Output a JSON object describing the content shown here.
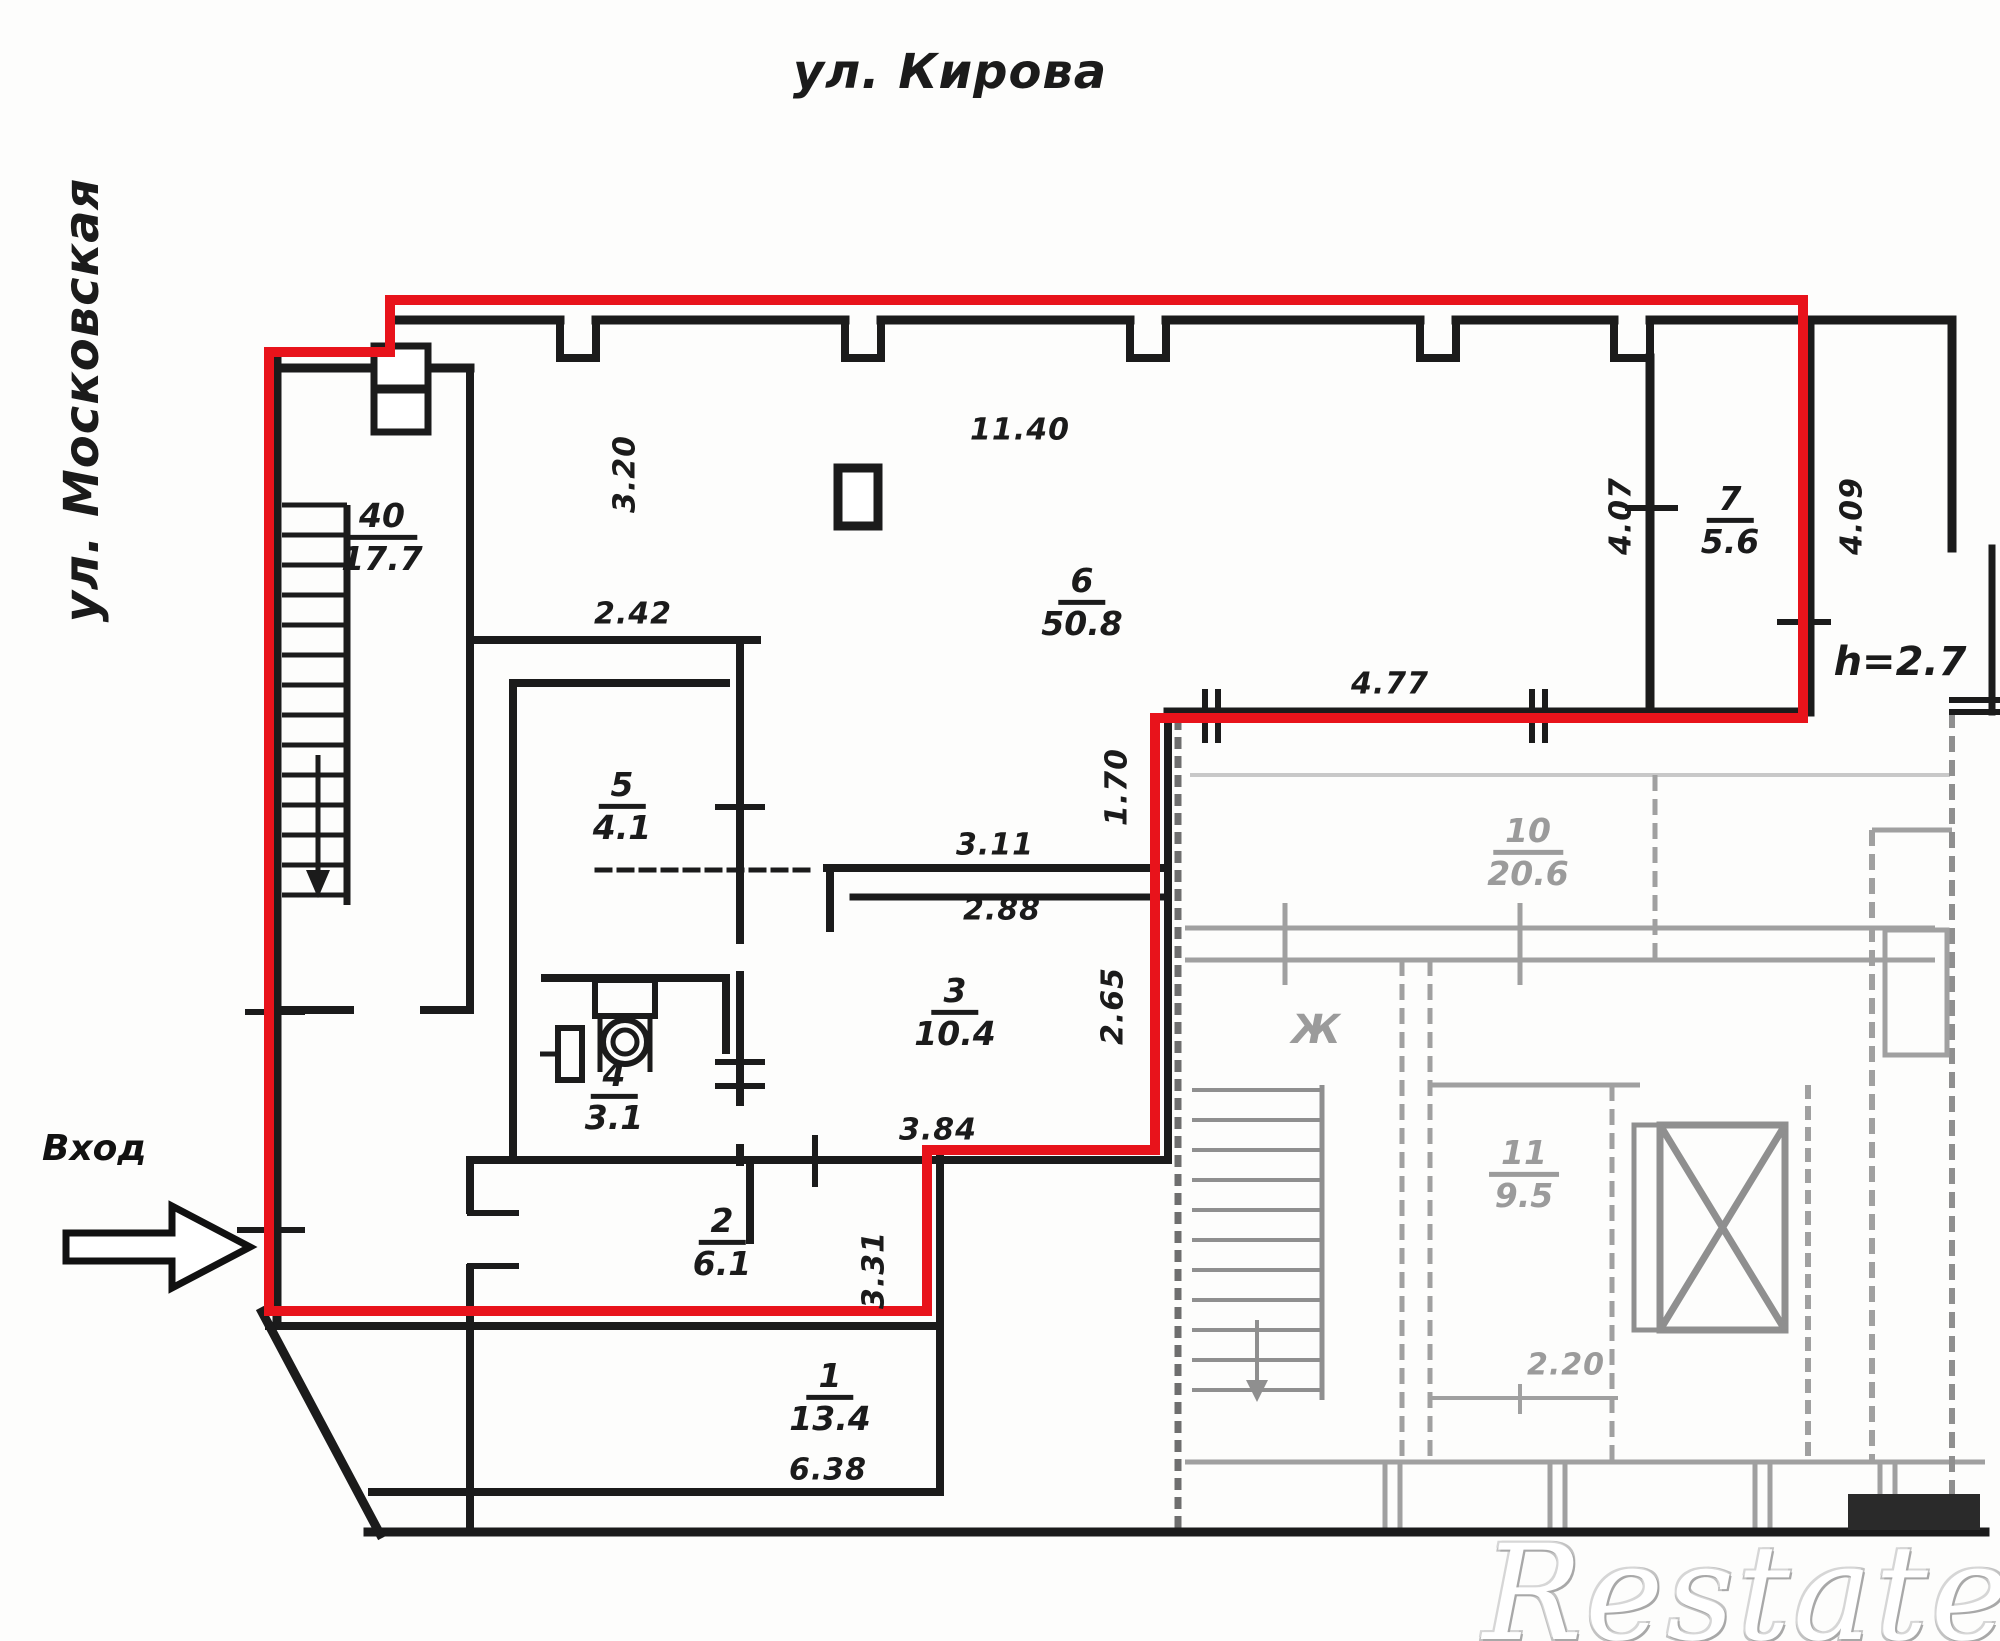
{
  "plan": {
    "streets": {
      "top": "ул. Кирова",
      "left": "ул. Московская"
    },
    "entrance_label": "Вход",
    "height_note": "h=2.7",
    "watermark": "Restate",
    "rooms": [
      {
        "number": "40",
        "area": "17.7"
      },
      {
        "number": "6",
        "area": "50.8"
      },
      {
        "number": "7",
        "area": "5.6"
      },
      {
        "number": "5",
        "area": "4.1"
      },
      {
        "number": "4",
        "area": "3.1"
      },
      {
        "number": "3",
        "area": "10.4"
      },
      {
        "number": "2",
        "area": "6.1"
      },
      {
        "number": "1",
        "area": "13.4"
      },
      {
        "number": "10",
        "area": "20.6"
      },
      {
        "number": "11",
        "area": "9.5"
      }
    ],
    "other_room_label": "Ж",
    "dimensions": {
      "d1140": "11.40",
      "d320": "3.20",
      "d242": "2.42",
      "d477": "4.77",
      "d170": "1.70",
      "d265": "2.65",
      "d311": "3.11",
      "d288": "2.88",
      "d384": "3.84",
      "d638": "6.38",
      "d331": "3.31",
      "d407": "4.07",
      "d409": "4.09",
      "d220": "2.20"
    },
    "colors": {
      "boundary": "#e8131b",
      "walls": "#1b1b1b",
      "faint": "#9b9b9b"
    }
  }
}
